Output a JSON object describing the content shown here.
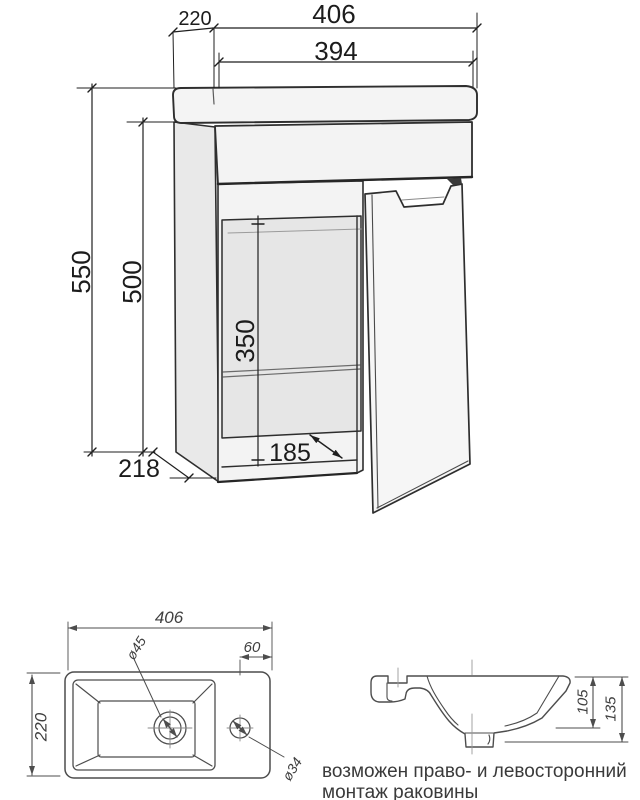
{
  "front_view": {
    "width_top": "406",
    "width_basin": "394",
    "depth_top": "220",
    "height_total": "550",
    "height_cabinet": "500",
    "opening_height": "350",
    "interior_depth": "185",
    "depth_bottom": "218"
  },
  "plan_view": {
    "width": "406",
    "depth": "220",
    "faucet_offset": "60",
    "drain_diameter": "ø45",
    "faucet_diameter": "ø34"
  },
  "profile_view": {
    "height_to_bowl": "105",
    "height_total": "135"
  },
  "note": {
    "line1": "возможен право- и левосторонний",
    "line2": "монтаж раковины"
  },
  "colors": {
    "main_line": "#2e2e2e",
    "dimension_line": "#1f1f1f",
    "sketch_line": "#4d4d4d",
    "note_text": "#3a3a3a"
  }
}
